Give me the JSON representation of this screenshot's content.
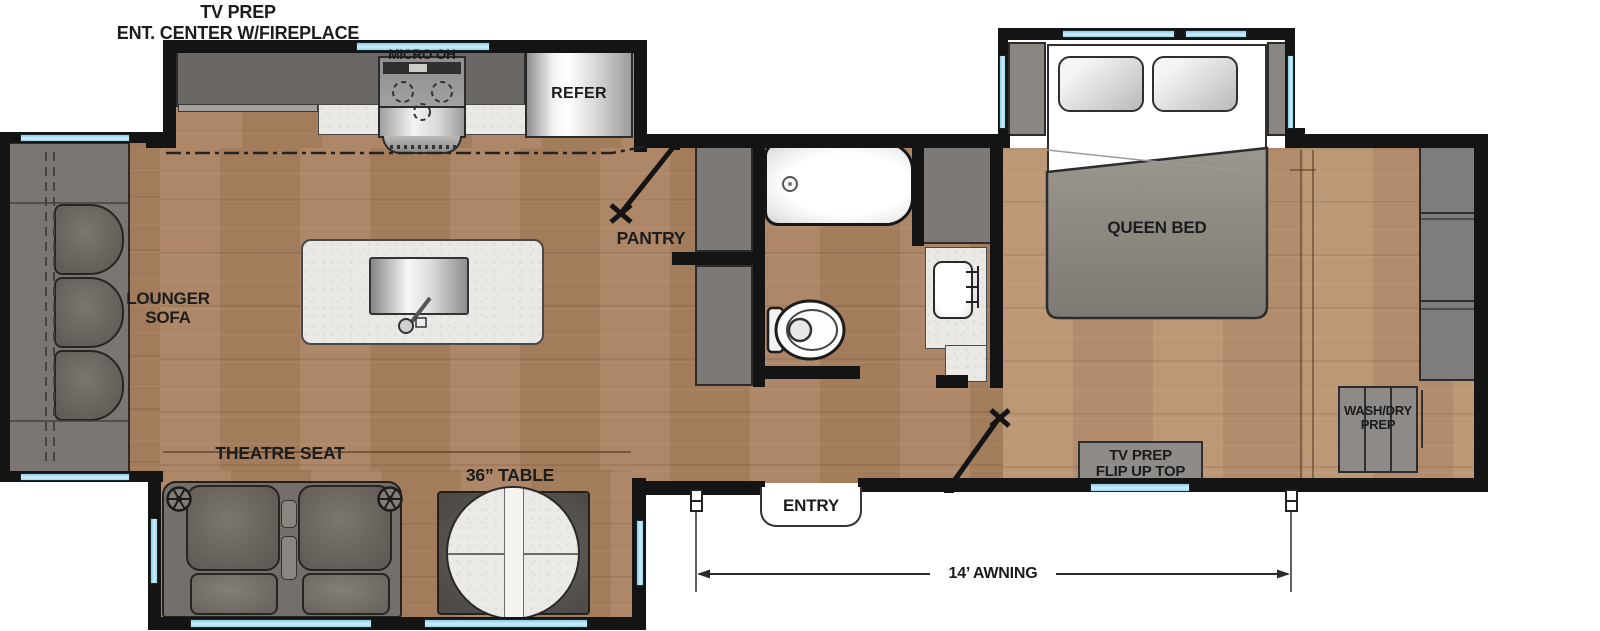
{
  "floorplan": {
    "type": "rv-travel-trailer-floor-plan",
    "labels": {
      "ent_center_l1": "TV PREP",
      "ent_center_l2": "ENT. CENTER W/FIREPLACE",
      "micro_oh": "MICRO OH",
      "refer": "REFER",
      "pantry": "PANTRY",
      "lounger_l1": "LOUNGER",
      "lounger_l2": "SOFA",
      "queen_bed": "QUEEN BED",
      "theatre_seat": "THEATRE SEAT",
      "table": "36” TABLE",
      "entry": "ENTRY",
      "tv_prep_l1": "TV PREP",
      "tv_prep_l2": "FLIP UP TOP",
      "wash_dry_l1": "WASH/DRY",
      "wash_dry_l2": "PREP",
      "awning": "14’ AWNING"
    },
    "colors": {
      "wall": "#141414",
      "floor_main": "#a9815f",
      "floor_bedroom": "#b99270",
      "cabinet": "#7c7976",
      "cabinet_dark": "#6b6764",
      "seat_gray": "#6e6a64",
      "window_blue": "#b5e0f0",
      "counter_marble": "#eae9e5",
      "label_text": "#1c1c1c"
    }
  }
}
